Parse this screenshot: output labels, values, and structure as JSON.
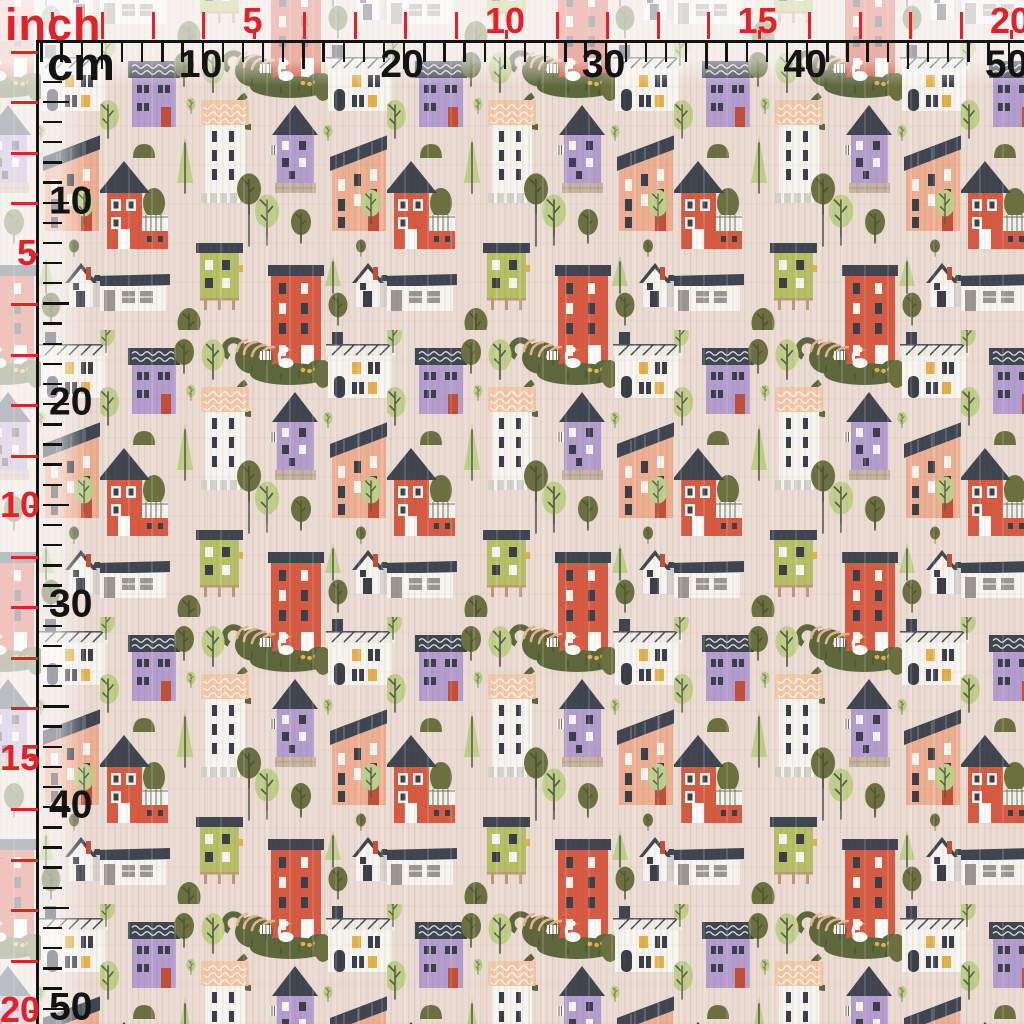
{
  "meta": {
    "description": "Fabric swatch with seamless tiny-town houses pattern, measured by overlaid inch and centimeter rulers along the top and left edges"
  },
  "rulers": {
    "inch_label": "inch",
    "cm_label": "cm",
    "inch_color": "#e42127",
    "cm_color": "#131313",
    "px_per_inch": 50.5,
    "px_per_cm": 20.15,
    "inch_max": 20,
    "cm_max": 50,
    "inch_numbers": [
      5,
      10,
      15,
      20
    ],
    "cm_numbers": [
      10,
      20,
      30,
      40,
      50
    ]
  },
  "fabric": {
    "background": "#ebdcd3",
    "palette": {
      "bg": "#ebdcd3",
      "roof": "#3e4551",
      "purple": "#b39ecf",
      "whitehouse": "#f7f5f0",
      "peachroof": "#f5c9a7",
      "salmon": "#eeb093",
      "red": "#d65b42",
      "reddark": "#c24f36",
      "lime": "#b6c166",
      "olive": "#6a713f",
      "lightgreen": "#bfd088",
      "graylight": "#d5d2ca",
      "graymid": "#9b978f",
      "windark": "#3a3e49",
      "yellow": "#e6b14a",
      "tan": "#bf9a77",
      "pond": "#5c683b",
      "goose": "#fdfdfb",
      "beak": "#e08a3c",
      "trunk": "#5a5c4c",
      "brick": "#c8b6a1",
      "hatch": "#f0ede5"
    },
    "motifs": [
      "purple-house-wavy-roof",
      "white-house-peach-scalloped-roof",
      "purple-gable-house-stone-base",
      "salmon-apartment-slanted-roof",
      "red-gable-house-with-white-terrace",
      "lime-stilt-house",
      "red-tall-house",
      "white-shed",
      "gray-gable-house",
      "white-corner-house-hatched-roof",
      "goose-pond-with-ducklings",
      "round-olive-trees",
      "round-light-green-trees",
      "thin-conifers",
      "bushes"
    ]
  }
}
